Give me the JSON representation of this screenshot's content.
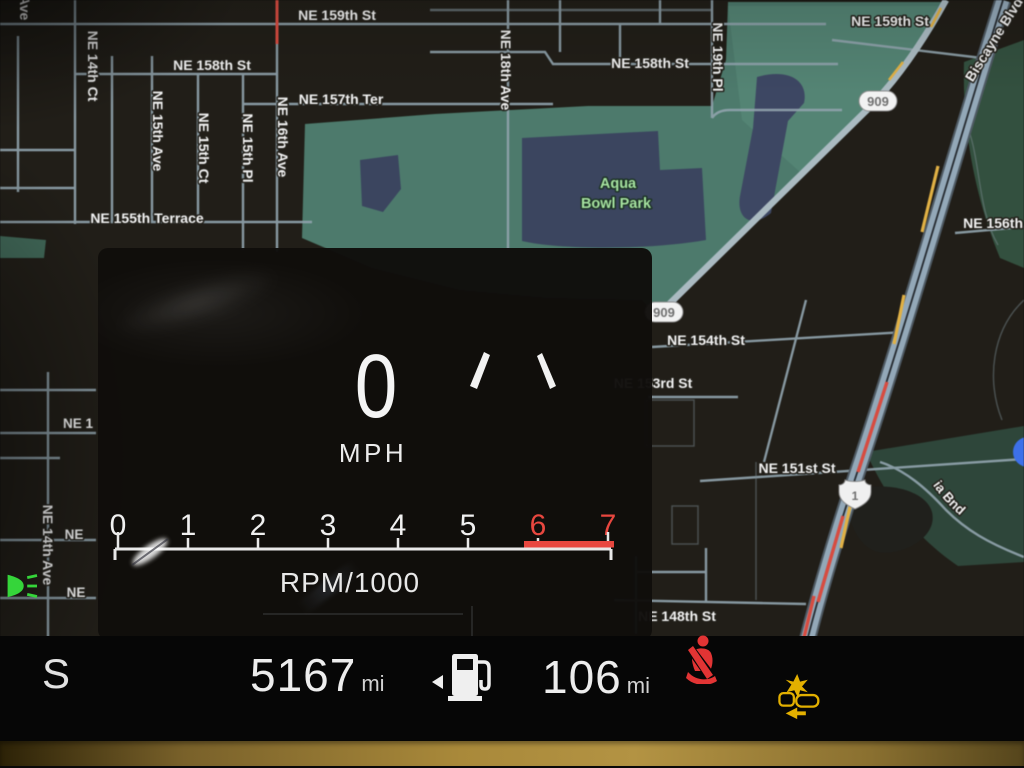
{
  "map": {
    "park_label_line1": "Aqua",
    "park_label_line2": "Bowl Park",
    "shields": {
      "route_909": "909",
      "us_1": "1"
    },
    "streets": {
      "s159_left": "NE 159th St",
      "s159_right": "NE 159th St",
      "s158_left": "NE 158th St",
      "s158_right": "NE 158th St",
      "s157_ter": "NE 157th Ter",
      "s156": "NE 156th St",
      "s155_terrace": "NE 155th Terrace",
      "s154": "NE 154th St",
      "s153": "NE 153rd St",
      "s151": "NE 151st St",
      "s148": "NE 148th St",
      "sole_mia": "Sole Mia Bnd",
      "biscayne": "Biscayne Blvd",
      "a14_ct": "NE 14th Ct",
      "a14_ave": "NE 14th Ave",
      "a14_ave_top": "NE 14th Ave",
      "a15_ave": "NE 15th Ave",
      "a15_ct": "NE 15th Ct",
      "a15_pl": "NE 15th Pl",
      "a16_ave": "NE 16th Ave",
      "a18_ave": "NE 18th Ave",
      "a19_pl": "NE 19th Pl",
      "partial_ne1": "NE 1",
      "partial_ne_a": "NE",
      "partial_ne_b": "NE"
    }
  },
  "cluster": {
    "speed_value": "0",
    "speed_unit": "MPH",
    "tach_label": "RPM/1000",
    "tach_ticks": [
      "0",
      "1",
      "2",
      "3",
      "4",
      "5",
      "6",
      "7"
    ]
  },
  "status_bar": {
    "gear_indicator": "S",
    "odometer_value": "5167",
    "odometer_unit": "mi",
    "range_value": "106",
    "range_unit": "mi"
  },
  "icons": {
    "fuel": "fuel-pump-icon",
    "fuel_door": "fuel-door-arrow-left",
    "seatbelt": "seatbelt-warning-icon",
    "collision": "forward-collision-alert-icon",
    "headlight": "low-beam-headlight-icon",
    "location": "current-location-dot"
  },
  "colors": {
    "road": "#93a9ba",
    "park": "#4b7b6c",
    "water": "#3a4560",
    "traffic_red": "#dd4a3e",
    "traffic_yellow": "#e3b13f",
    "redline": "#e8473f",
    "warning_red": "#e23434",
    "warning_amber": "#e3b000",
    "telltale_green": "#35d53a",
    "label": "#f2f2f2",
    "park_label": "#a4e49e"
  }
}
